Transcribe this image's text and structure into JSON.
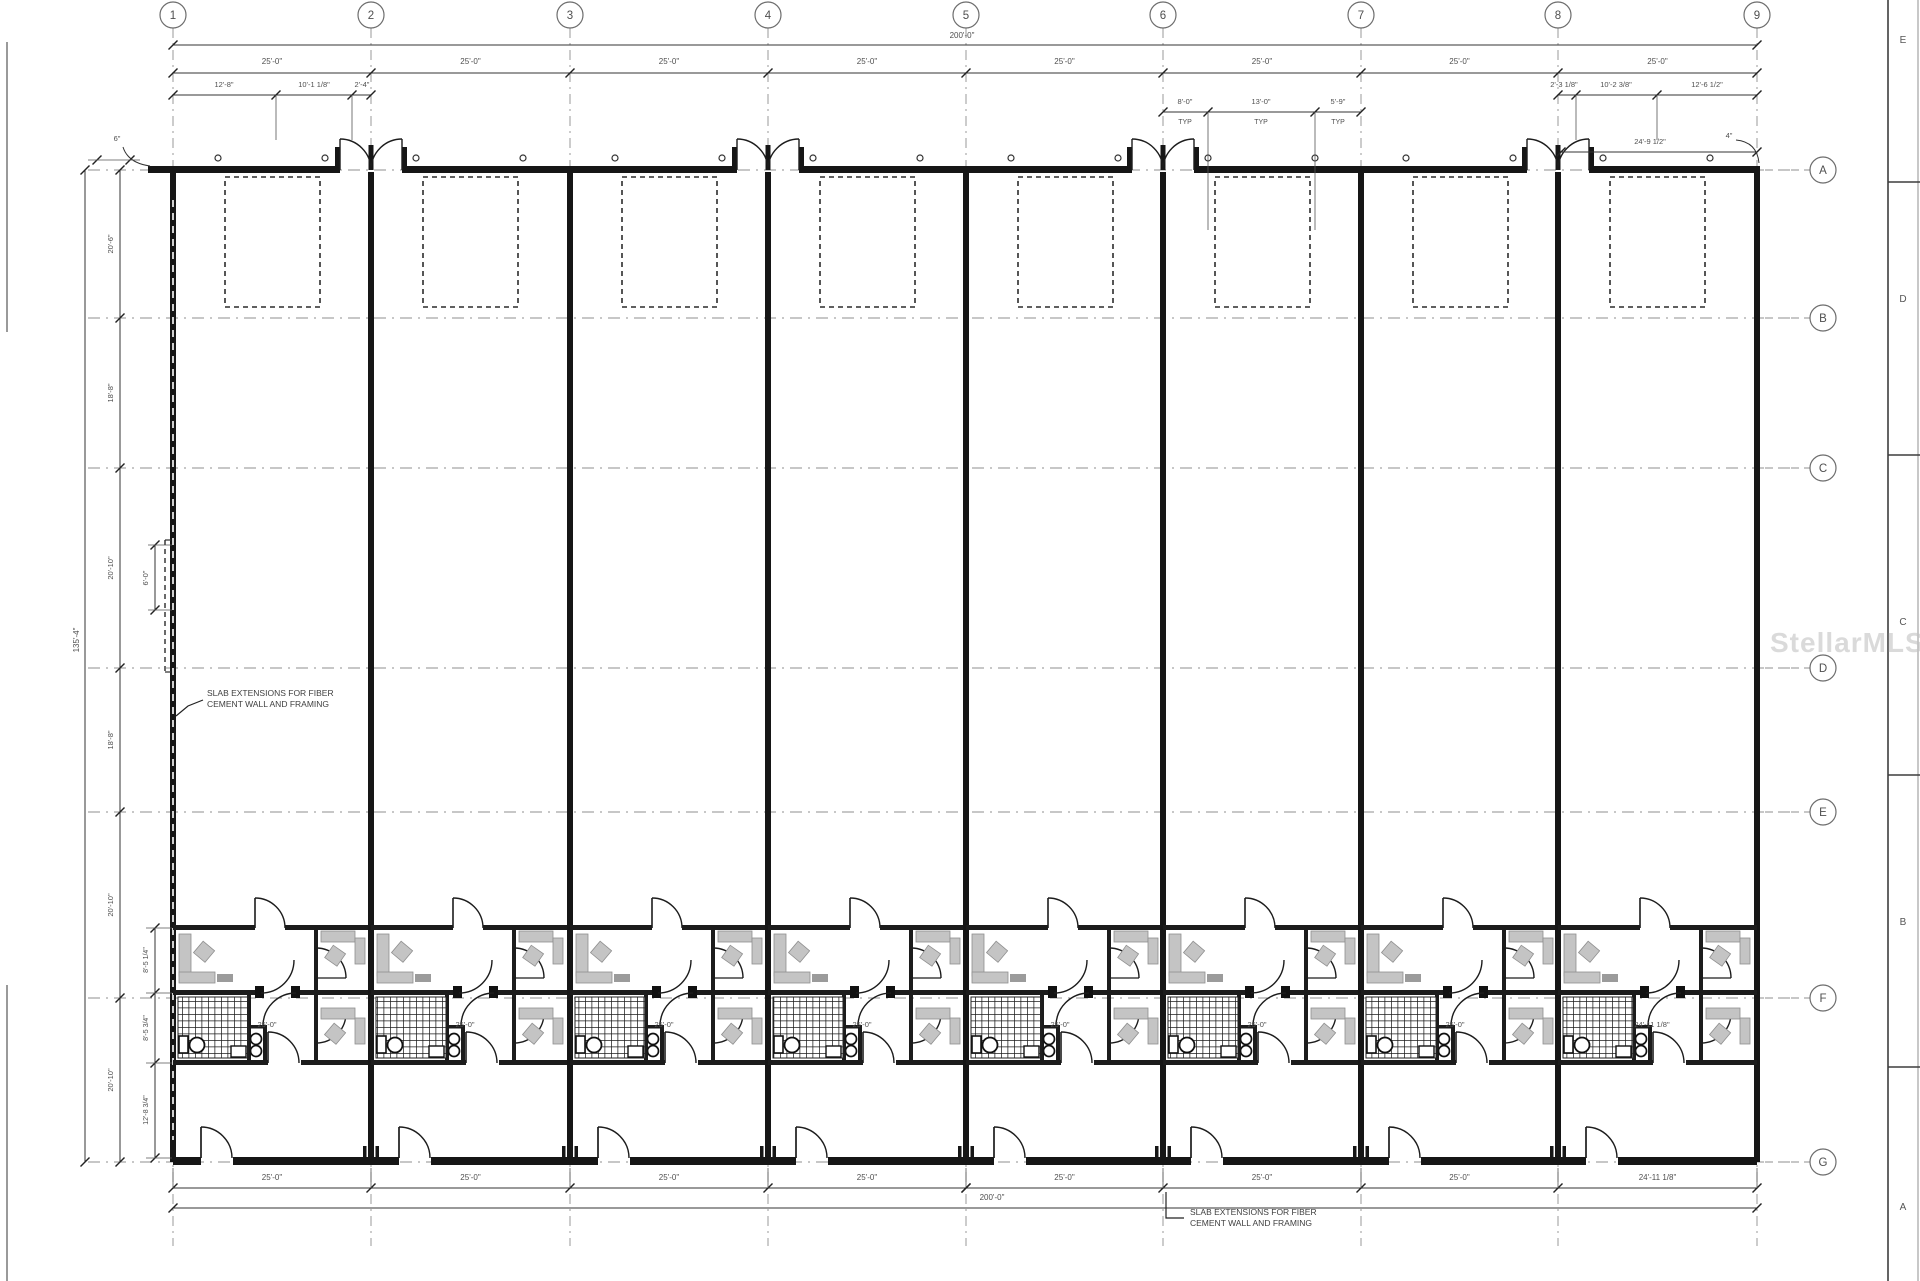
{
  "page": {
    "watermark": "StellarMLS",
    "background": "#ffffff"
  },
  "grid": {
    "columns": {
      "labels": [
        "1",
        "2",
        "3",
        "4",
        "5",
        "6",
        "7",
        "8",
        "9"
      ],
      "x": [
        173,
        371,
        570,
        768,
        966,
        1163,
        1361,
        1558,
        1757
      ]
    },
    "rows": {
      "labels": [
        "A",
        "B",
        "C",
        "D",
        "E",
        "F",
        "G"
      ],
      "y": [
        170,
        318,
        468,
        668,
        812,
        998,
        1162
      ]
    }
  },
  "edge_strip": {
    "letters": [
      {
        "label": "E",
        "y": 43
      },
      {
        "label": "D",
        "y": 302
      },
      {
        "label": "C",
        "y": 625
      },
      {
        "label": "B",
        "y": 925
      },
      {
        "label": "A",
        "y": 1210
      }
    ]
  },
  "dimensions": {
    "top_total": "200'-0\"",
    "top_segments": [
      "25'-0\"",
      "25'-0\"",
      "25'-0\"",
      "25'-0\"",
      "25'-0\"",
      "25'-0\"",
      "25'-0\"",
      "25'-0\""
    ],
    "bay1_subdims": [
      "12'-8\"",
      "10'-1 1/8\"",
      "2'-4\""
    ],
    "bay6_subdims": [
      "8'-0\"",
      "13'-0\"",
      "5'-9\""
    ],
    "bay6_suffix": "TYP",
    "bay8_subdims": [
      "2'-3 1/8\"",
      "10'-2 3/8\"",
      "12'-6 1/2\""
    ],
    "top_right_dim": "24'-9 1/2\"",
    "top_right_callout": "4\"",
    "top_left_callout": "6\"",
    "left_total": "135'-4\"",
    "left_segments": [
      "20'-6\"",
      "18'-8\"",
      "20'-10\"",
      "18'-8\"",
      "20'-10\"",
      "20'-10\""
    ],
    "left_inner_slab_dim": "6'-0\"",
    "left_inner_rooms": [
      "8'-5 1/4\"",
      "8'-5 3/4\"",
      "12'-8 3/4\""
    ],
    "bottom_segments": [
      "25'-0\"",
      "25'-0\"",
      "25'-0\"",
      "25'-0\"",
      "25'-0\"",
      "25'-0\"",
      "25'-0\"",
      "24'-11 1/8\""
    ],
    "bottom_total": "200'-0\"",
    "unit_width_labels": [
      "25'-0\"",
      "25'-0\"",
      "25'-0\"",
      "25'-0\"",
      "25'-0\"",
      "25'-0\"",
      "25'-0\"",
      "24'-11 1/8\""
    ]
  },
  "notes": {
    "slab_line1": "SLAB EXTENSIONS FOR FIBER",
    "slab_line2": "CEMENT WALL AND FRAMING"
  },
  "colors": {
    "wall": "#161616",
    "line": "#4a4a4a",
    "dim_text": "#4f4f4f",
    "grid_dash": "#8f8f8f",
    "furniture": "#c4c4c4",
    "watermark": "#c3c3c3"
  }
}
